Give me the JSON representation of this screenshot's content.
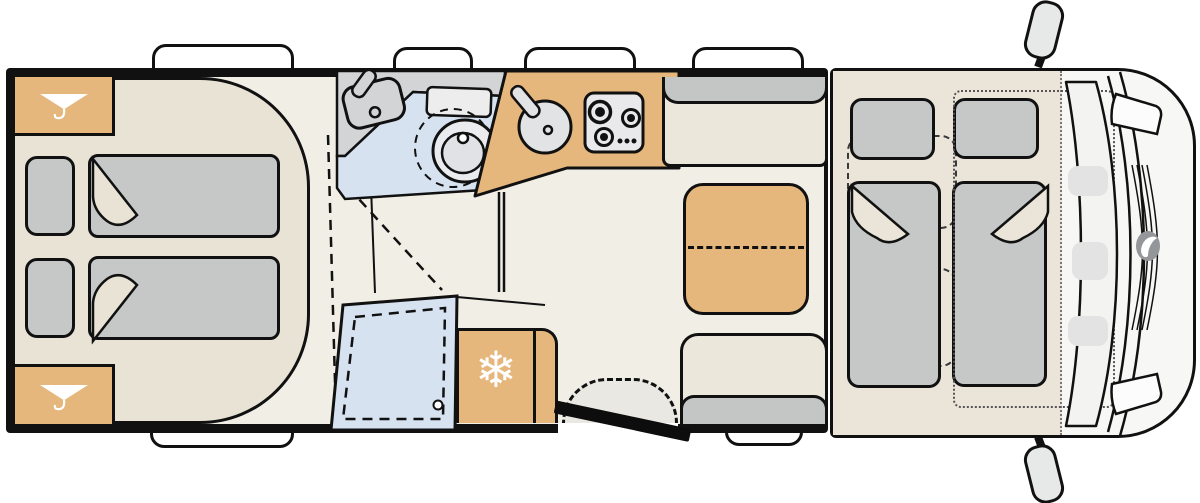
{
  "diagram": {
    "type": "motorhome-floorplan-top-view",
    "front_of_vehicle": "right",
    "zones": [
      {
        "name": "rear-bedroom",
        "fixtures": [
          "wardrobe-top",
          "wardrobe-bottom",
          "twin-bed-upper",
          "twin-bed-lower",
          "pillow-upper",
          "pillow-lower",
          "bed-platform"
        ]
      },
      {
        "name": "bathroom",
        "fixtures": [
          "washbasin",
          "faucet",
          "swivel-toilet",
          "toilet-swing-outline"
        ]
      },
      {
        "name": "shower",
        "fixtures": [
          "shower-tray",
          "drain",
          "folding-door-swing"
        ]
      },
      {
        "name": "kitchen",
        "fixtures": [
          "round-sink",
          "faucet",
          "hob-three-burner",
          "refrigerator"
        ]
      },
      {
        "name": "dinette",
        "fixtures": [
          "extendable-table",
          "bench-seat-front",
          "bench-seat-rear"
        ]
      },
      {
        "name": "cab",
        "fixtures": [
          "drop-down-bed-left",
          "drop-down-bed-right",
          "pillow-left",
          "pillow-right",
          "driver-seat-outline",
          "passenger-seat-outline",
          "steering-wheel-outline",
          "bed-frame-outline",
          "windshield",
          "hood",
          "grille",
          "brand-logo",
          "headlight-top",
          "headlight-bottom",
          "side-mirror-top",
          "side-mirror-bottom"
        ]
      },
      {
        "name": "entrance",
        "fixtures": [
          "entry-door-open",
          "entry-step-swing"
        ]
      }
    ],
    "windows": {
      "top_wall": 4,
      "bottom_wall": 2
    }
  },
  "icons": {
    "wardrobe": "clothes-hanger-icon",
    "refrigerator": "snowflake-icon",
    "snowflake_glyph": "❄"
  },
  "colors": {
    "wall": "#111111",
    "floor": "#f1eee6",
    "platform": "#e8e3d5",
    "tan": "#e6b77d",
    "gray": "#c5c8c7",
    "headrest": "#c3c6c5",
    "seat": "#ebe7db",
    "blue": "#d7e2f1",
    "counter": "#d2d4d6",
    "cabfloor": "#eae5d8",
    "cabbody": "#f7f7f5",
    "step": "#e9e8e2",
    "logo": "#95969a",
    "white": "#ffffff"
  }
}
